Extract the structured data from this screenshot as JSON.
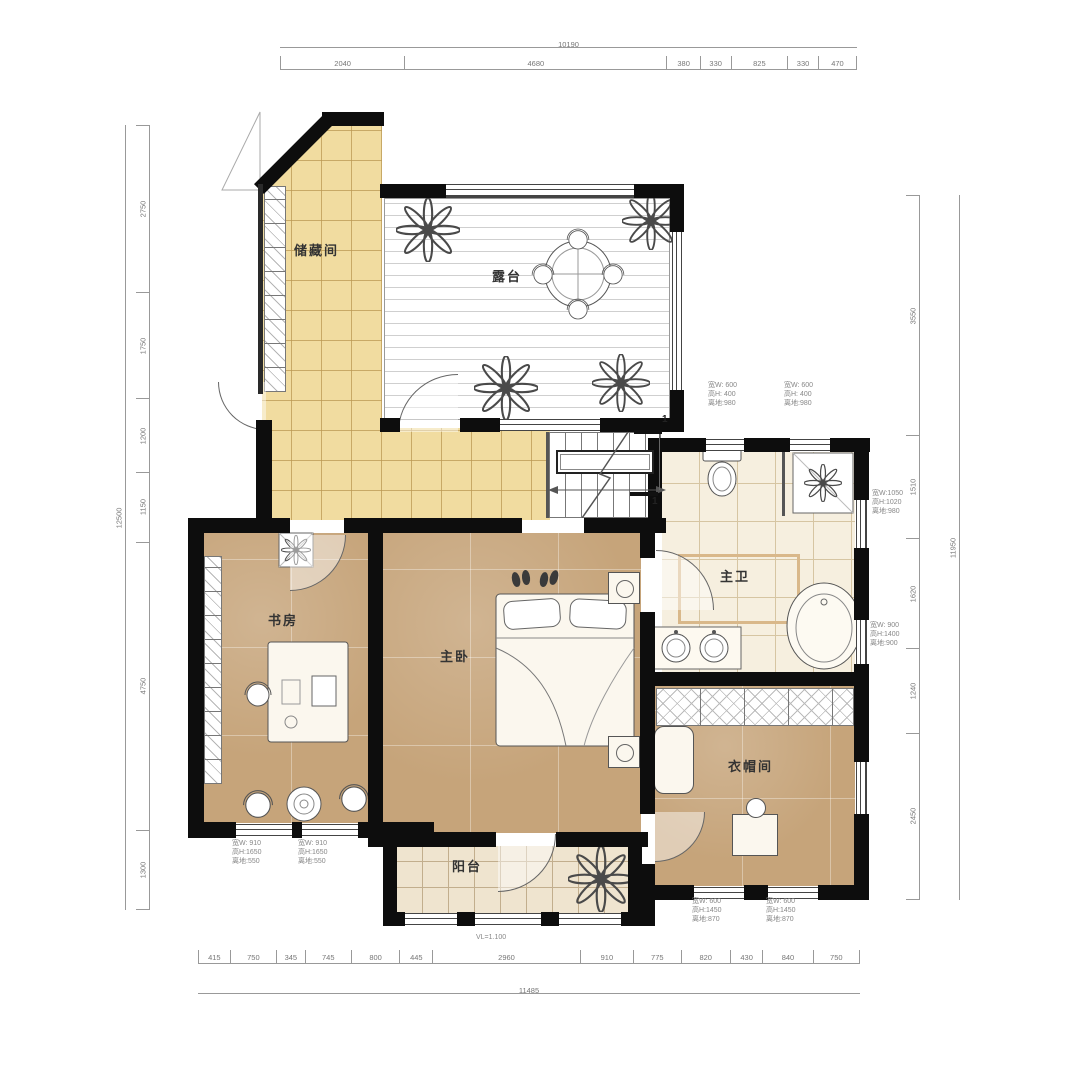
{
  "drawing": {
    "type": "residential-floor-plan",
    "rooms": {
      "storage": "储藏间",
      "terrace": "露台",
      "study": "书房",
      "master_bedroom": "主卧",
      "master_bath": "主卫",
      "cloakroom": "衣帽间",
      "balcony": "阳台"
    },
    "dimensions": {
      "top": {
        "total": "10190",
        "segments": [
          {
            "v": "2040"
          },
          {
            "v": "4680"
          },
          {
            "v": "380"
          },
          {
            "v": "330"
          },
          {
            "v": "825"
          },
          {
            "v": "330"
          },
          {
            "v": "470"
          }
        ]
      },
      "bottom": {
        "total": "11485",
        "segments": [
          {
            "v": "415"
          },
          {
            "v": "750"
          },
          {
            "v": "345"
          },
          {
            "v": "745"
          },
          {
            "v": "800"
          },
          {
            "v": "445"
          },
          {
            "v": "2960"
          },
          {
            "v": "910"
          },
          {
            "v": "775"
          },
          {
            "v": "820"
          },
          {
            "v": "430"
          },
          {
            "v": "840"
          },
          {
            "v": "750"
          }
        ]
      },
      "left": {
        "total": "12500",
        "segments": [
          {
            "v": "2750"
          },
          {
            "v": "1750"
          },
          {
            "v": "1200"
          },
          {
            "v": "1150"
          },
          {
            "v": "4750"
          },
          {
            "v": "1300"
          }
        ]
      },
      "right": {
        "total": "11950",
        "segments": [
          {
            "v": "3550"
          },
          {
            "v": "1510"
          },
          {
            "v": "1620"
          },
          {
            "v": "1240"
          },
          {
            "v": "2450"
          }
        ]
      }
    },
    "window_notes": [
      {
        "l1": "宽W: 600",
        "l2": "高H: 400",
        "l3": "离地:980"
      },
      {
        "l1": "宽W: 600",
        "l2": "高H: 400",
        "l3": "离地:980"
      },
      {
        "l1": "宽W:1050",
        "l2": "高H:1020",
        "l3": "离地:980"
      },
      {
        "l1": "宽W: 900",
        "l2": "高H:1400",
        "l3": "离地:900"
      },
      {
        "l1": "宽W: 910",
        "l2": "高H:1650",
        "l3": "离地:550"
      },
      {
        "l1": "宽W: 910",
        "l2": "高H:1650",
        "l3": "离地:550"
      },
      {
        "l1": "宽W: 600",
        "l2": "高H:1450",
        "l3": "离地:870"
      },
      {
        "l1": "宽W: 600",
        "l2": "高H:1450",
        "l3": "离地:870"
      }
    ],
    "balcony_note": "VL=1.100",
    "section_marks": {
      "a": "1",
      "b": "1"
    },
    "colors": {
      "wall": "#0d0d0d",
      "floor_wood": "#c6a47a",
      "floor_tile_yellow": "#f1dca0",
      "floor_tile_cream": "#f6efdf",
      "floor_tile_balcony": "#efe4cf",
      "dimension_text": "#777777",
      "label_text": "#333333"
    }
  }
}
